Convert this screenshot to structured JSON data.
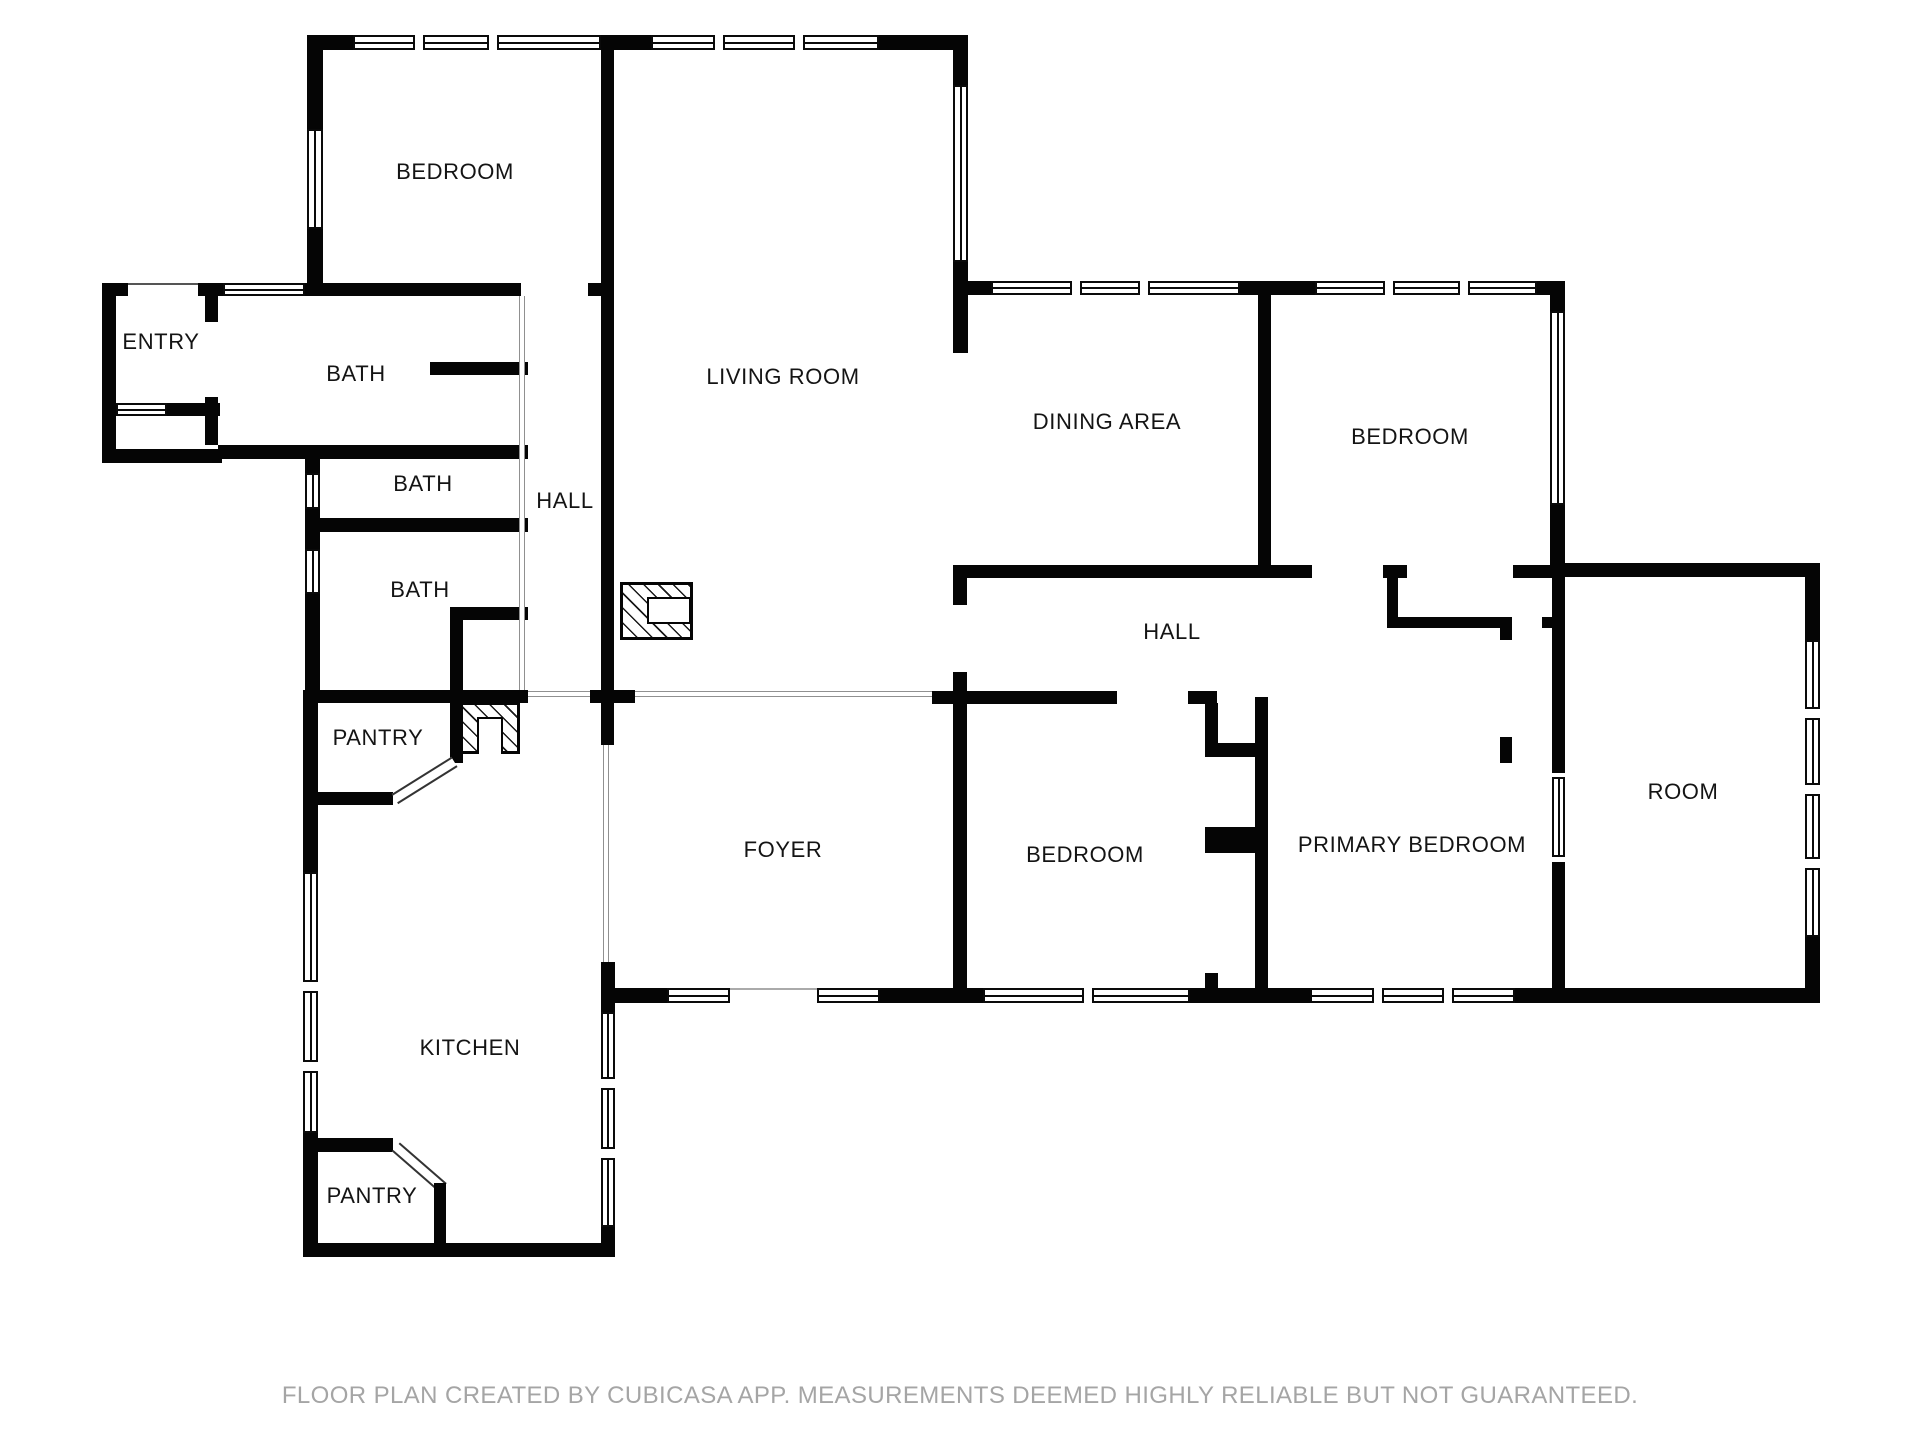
{
  "title": "Floor plan",
  "colors": {
    "wall": "#050505",
    "background": "#ffffff",
    "label_text": "#141414",
    "open_boundary_line": "#909090",
    "footer_text": "#a5a5a5"
  },
  "rooms": [
    {
      "name": "BEDROOM"
    },
    {
      "name": "ENTRY"
    },
    {
      "name": "BATH"
    },
    {
      "name": "BATH"
    },
    {
      "name": "HALL"
    },
    {
      "name": "BATH"
    },
    {
      "name": "LIVING ROOM"
    },
    {
      "name": "DINING AREA"
    },
    {
      "name": "BEDROOM"
    },
    {
      "name": "HALL"
    },
    {
      "name": "PANTRY"
    },
    {
      "name": "FOYER"
    },
    {
      "name": "KITCHEN"
    },
    {
      "name": "BEDROOM"
    },
    {
      "name": "PRIMARY BEDROOM"
    },
    {
      "name": "ROOM"
    },
    {
      "name": "PANTRY"
    }
  ],
  "icons": [
    {
      "name": "fireplace-icon"
    },
    {
      "name": "water-heater-icon"
    }
  ],
  "footer": {
    "disclaimer": "FLOOR PLAN CREATED BY CUBICASA APP. MEASUREMENTS DEEMED HIGHLY RELIABLE BUT NOT GUARANTEED."
  }
}
